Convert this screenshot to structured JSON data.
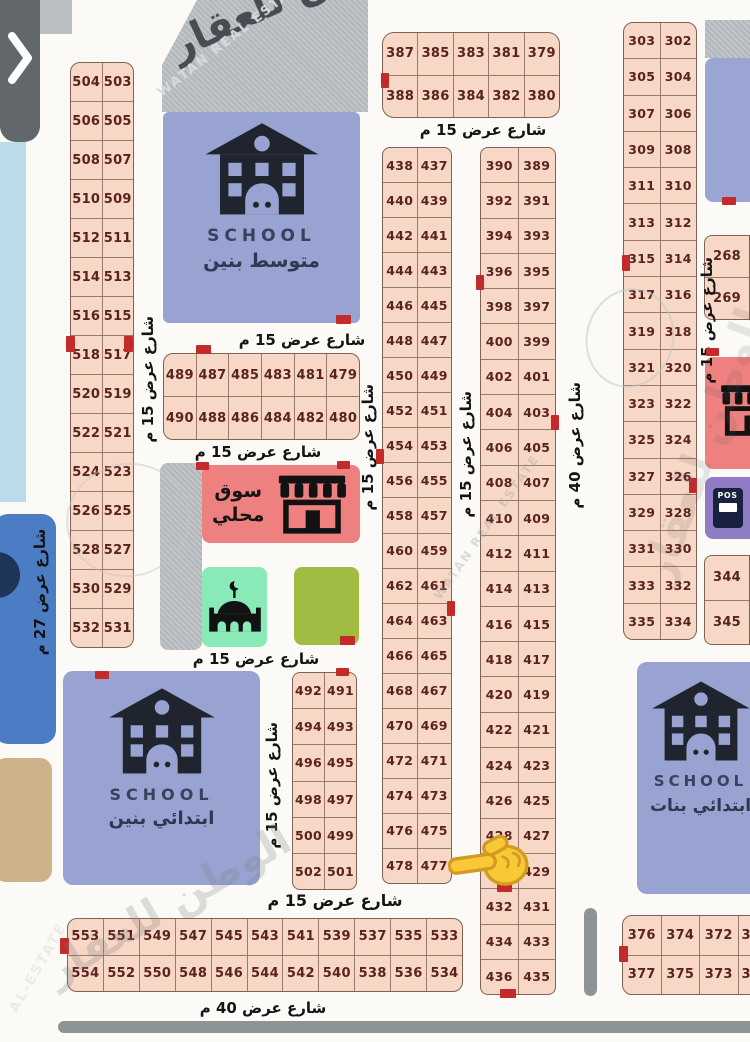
{
  "ui": {
    "collapse_chevron": "❯"
  },
  "streets": {
    "w15": "شارع عرض 15 م",
    "w27": "شارع عرض 27 م",
    "w40": "شارع عرض 40 م"
  },
  "facilities": {
    "school_label": "SCHOOL",
    "middle_boys": "متوسط بنين",
    "elementary_boys": "ابتدائي بنين",
    "elementary_girls": "ابتدائي بنات",
    "market_line1": "سوق",
    "market_line2": "محلي",
    "pos": "POS"
  },
  "watermarks": {
    "brand_ar": "الوطن للعقار",
    "brand_en": "WATAN REAL ESTATE",
    "brand_en_short": "AL-ESTATE"
  },
  "plots": {
    "left_column": [
      [
        "504",
        "503"
      ],
      [
        "506",
        "505"
      ],
      [
        "508",
        "507"
      ],
      [
        "510",
        "509"
      ],
      [
        "512",
        "511"
      ],
      [
        "514",
        "513"
      ],
      [
        "516",
        "515"
      ],
      [
        "518",
        "517"
      ],
      [
        "520",
        "519"
      ],
      [
        "522",
        "521"
      ],
      [
        "524",
        "523"
      ],
      [
        "526",
        "525"
      ],
      [
        "528",
        "527"
      ],
      [
        "530",
        "529"
      ],
      [
        "532",
        "531"
      ]
    ],
    "top_block": [
      [
        "387",
        "385",
        "383",
        "381",
        "379"
      ],
      [
        "388",
        "386",
        "384",
        "382",
        "380"
      ]
    ],
    "block_480s": [
      [
        "489",
        "487",
        "485",
        "483",
        "481",
        "479"
      ],
      [
        "490",
        "488",
        "486",
        "484",
        "482",
        "480"
      ]
    ],
    "col_430s": [
      [
        "438",
        "437"
      ],
      [
        "440",
        "439"
      ],
      [
        "442",
        "441"
      ],
      [
        "444",
        "443"
      ],
      [
        "446",
        "445"
      ],
      [
        "448",
        "447"
      ],
      [
        "450",
        "449"
      ],
      [
        "452",
        "451"
      ],
      [
        "454",
        "453"
      ],
      [
        "456",
        "455"
      ],
      [
        "458",
        "457"
      ],
      [
        "460",
        "459"
      ],
      [
        "462",
        "461"
      ],
      [
        "464",
        "463"
      ],
      [
        "466",
        "465"
      ],
      [
        "468",
        "467"
      ],
      [
        "470",
        "469"
      ],
      [
        "472",
        "471"
      ],
      [
        "474",
        "473"
      ],
      [
        "476",
        "475"
      ],
      [
        "478",
        "477"
      ]
    ],
    "col_390s": [
      [
        "390",
        "389"
      ],
      [
        "392",
        "391"
      ],
      [
        "394",
        "393"
      ],
      [
        "396",
        "395"
      ],
      [
        "398",
        "397"
      ],
      [
        "400",
        "399"
      ],
      [
        "402",
        "401"
      ],
      [
        "404",
        "403"
      ],
      [
        "406",
        "405"
      ],
      [
        "408",
        "407"
      ],
      [
        "410",
        "409"
      ],
      [
        "412",
        "411"
      ],
      [
        "414",
        "413"
      ],
      [
        "416",
        "415"
      ],
      [
        "418",
        "417"
      ],
      [
        "420",
        "419"
      ],
      [
        "422",
        "421"
      ],
      [
        "424",
        "423"
      ],
      [
        "426",
        "425"
      ],
      [
        "428",
        "427"
      ],
      [
        "",
        "429"
      ],
      [
        "432",
        "431"
      ],
      [
        "434",
        "433"
      ],
      [
        "436",
        "435"
      ]
    ],
    "col_490s": [
      [
        "492",
        "491"
      ],
      [
        "494",
        "493"
      ],
      [
        "496",
        "495"
      ],
      [
        "498",
        "497"
      ],
      [
        "500",
        "499"
      ],
      [
        "502",
        "501"
      ]
    ],
    "right_column": [
      [
        "303",
        "302"
      ],
      [
        "305",
        "304"
      ],
      [
        "307",
        "306"
      ],
      [
        "309",
        "308"
      ],
      [
        "311",
        "310"
      ],
      [
        "313",
        "312"
      ],
      [
        "315",
        "314"
      ],
      [
        "317",
        "316"
      ],
      [
        "319",
        "318"
      ],
      [
        "321",
        "320"
      ],
      [
        "323",
        "322"
      ],
      [
        "325",
        "324"
      ],
      [
        "327",
        "326"
      ],
      [
        "329",
        "328"
      ],
      [
        "331",
        "330"
      ],
      [
        "333",
        "332"
      ],
      [
        "335",
        "334"
      ]
    ],
    "edge_268": [
      [
        "268"
      ],
      [
        "269"
      ]
    ],
    "edge_344": [
      [
        "344"
      ],
      [
        "345"
      ]
    ],
    "bottom_left": [
      [
        "553",
        "551",
        "549",
        "547",
        "545",
        "543",
        "541",
        "539",
        "537",
        "535",
        "533"
      ],
      [
        "554",
        "552",
        "550",
        "548",
        "546",
        "544",
        "542",
        "540",
        "538",
        "536",
        "534"
      ]
    ],
    "bottom_right": [
      [
        "376",
        "374",
        "372",
        "3"
      ],
      [
        "377",
        "375",
        "373",
        "3"
      ]
    ]
  }
}
